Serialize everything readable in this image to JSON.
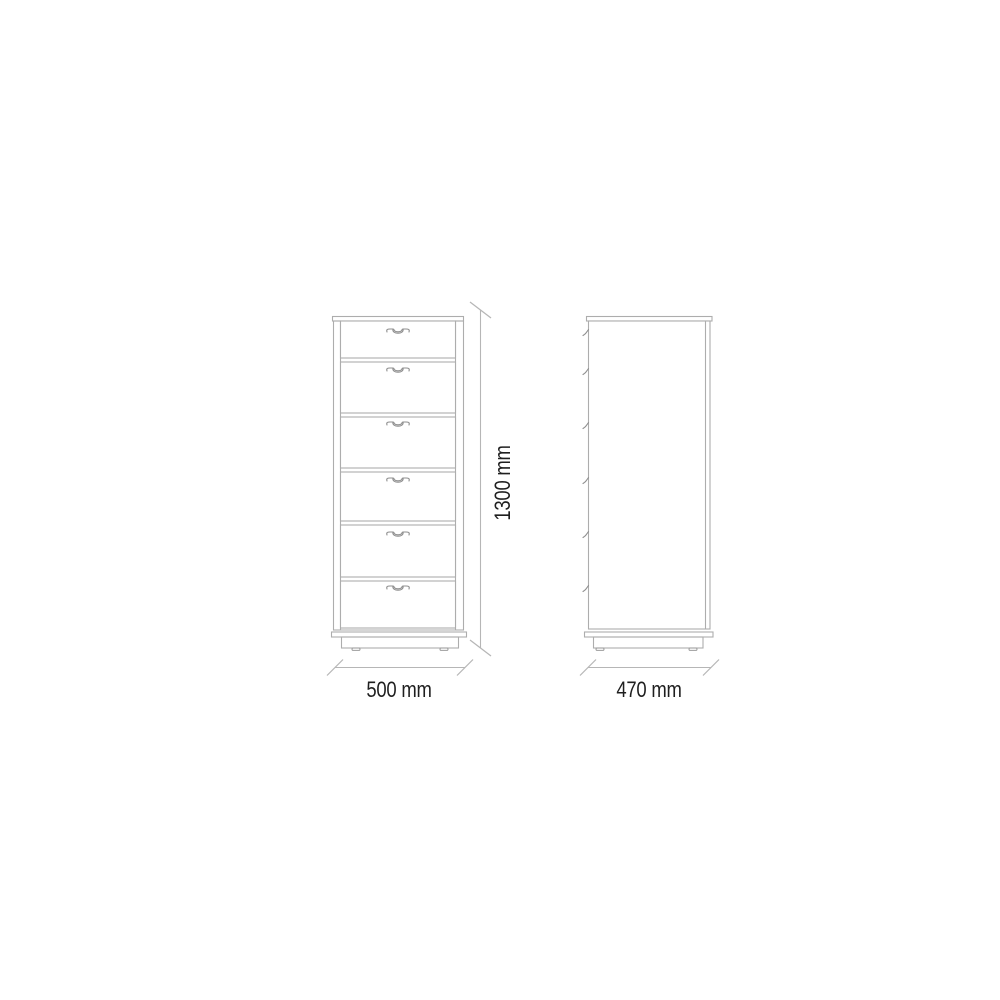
{
  "document": {
    "kind": "technical drawing",
    "subject": "six-drawer tallboy chest of drawers, front and side elevation with dimensions"
  },
  "theme": {
    "background": "#ffffff",
    "line_color": "#adadad",
    "detail_line_color": "#9c9c9c",
    "handle_color": "#8f8f8f",
    "dim_line_color": "#b6b6b6",
    "text_color": "#1f1f1f"
  },
  "drawing": {
    "views": {
      "front": {
        "name": "front elevation",
        "drawer_count": 6,
        "width": {
          "value": 500,
          "unit": "mm",
          "label": "500 mm"
        },
        "height": {
          "value": 1300,
          "unit": "mm",
          "label": "1300 mm"
        }
      },
      "side": {
        "name": "side elevation",
        "depth": {
          "value": 470,
          "unit": "mm",
          "label": "470 mm"
        }
      }
    }
  }
}
